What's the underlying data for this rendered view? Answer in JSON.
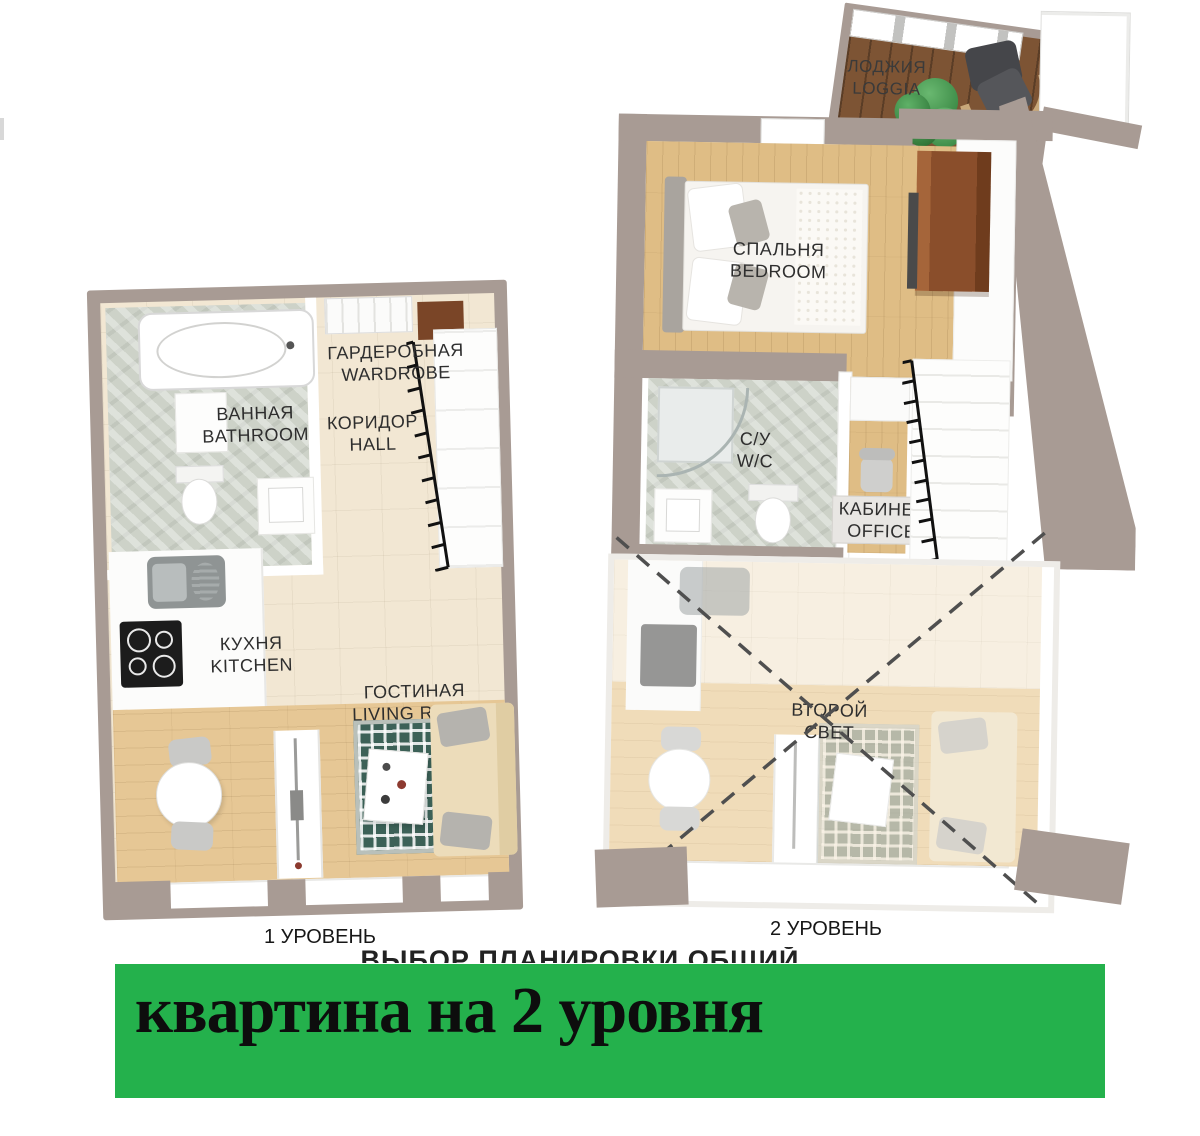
{
  "banner": {
    "text": "квартина на 2 уровня",
    "bg": "#24b14c"
  },
  "obscured_caption": {
    "text": "ВЫБОР ПЛАНИРОВКИ ОБЩИЙ"
  },
  "level1": {
    "caption": "1 УРОВЕНЬ",
    "bathroom_ru": "ВАННАЯ",
    "bathroom_en": "BATHROOM",
    "wardrobe_ru": "ГАРДЕРОБНАЯ",
    "wardrobe_en": "WARDROBE",
    "hall_ru": "КОРИДОР",
    "hall_en": "HALL",
    "kitchen_ru": "КУХНЯ",
    "kitchen_en": "KITCHEN",
    "living_ru": "ГОСТИНАЯ",
    "living_en": "LIVING ROOM"
  },
  "level2": {
    "caption": "2 УРОВЕНЬ",
    "loggia_ru": "ЛОДЖИЯ",
    "loggia_en": "LOGGIA",
    "bedroom_ru": "СПАЛЬНЯ",
    "bedroom_en": "BEDROOM",
    "wc_ru": "С/У",
    "wc_en": "W/C",
    "office_ru": "КАБИНЕТ",
    "office_en": "OFFICE",
    "void_ru1": "ВТОРОЙ",
    "void_ru2": "СВЕТ"
  },
  "colors": {
    "banner_green": "#24b14c",
    "wall_taupe": "#a89b94",
    "tile": "#f2e7d3",
    "wood": "#e6c795",
    "loggia_wood": "#7d5434",
    "marble": "#cdd2c8",
    "rug_teal": "#3c6157",
    "sofa_beige": "#ecdcba",
    "wardrobe_brown": "#8a4e2b"
  }
}
